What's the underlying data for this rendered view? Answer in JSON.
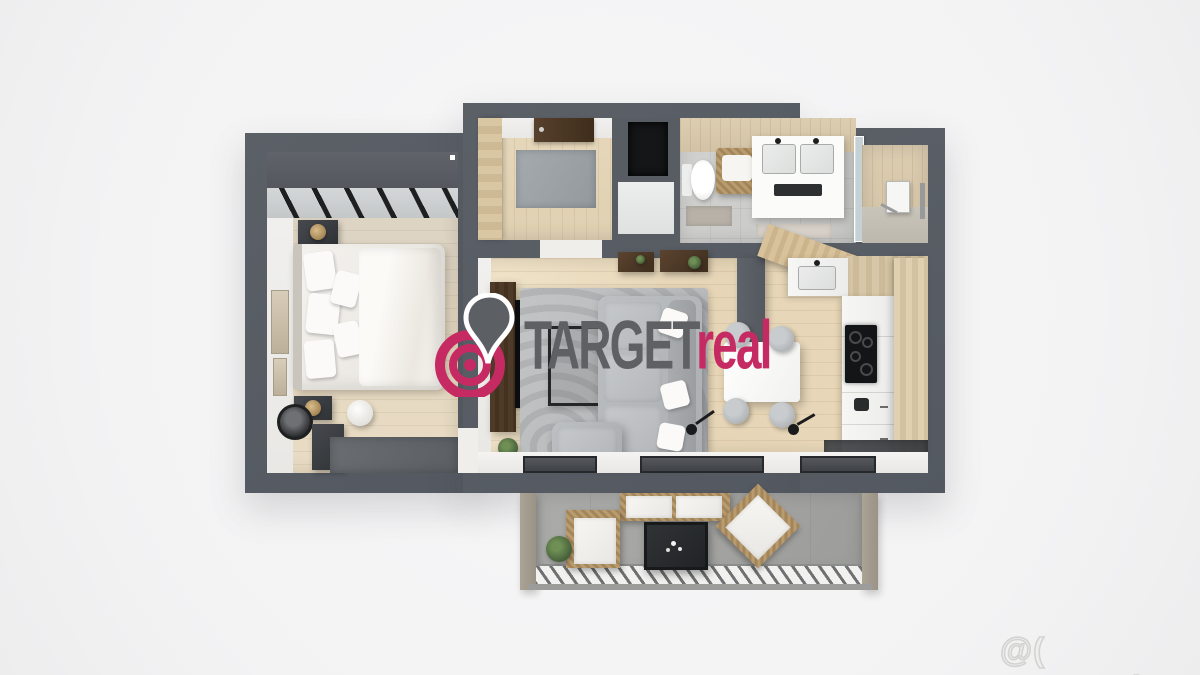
{
  "scene": {
    "description": "Top-down 3D render of a furnished apartment floor plan with balcony",
    "background_color": "#f5f5f6",
    "wall_color": "#575c63"
  },
  "agency_logo": {
    "icon": "map-pin-target-icon",
    "text_primary": "TARGET",
    "text_secondary": "real",
    "color_primary": "#5f6063",
    "color_accent": "#c62a63"
  },
  "site_watermark": {
    "text": "@( Bazos.sk",
    "color": "#d3d3d2"
  },
  "rooms": [
    {
      "name": "bedroom",
      "furnishings": [
        "double-bed",
        "nightstands-with-lamps",
        "built-in-wardrobe",
        "glass-partition",
        "dresser",
        "round-mirror",
        "pouf",
        "dark-rug",
        "wall-art"
      ]
    },
    {
      "name": "entry-hall",
      "furnishings": [
        "wardrobe",
        "entry-door",
        "gray-rug"
      ]
    },
    {
      "name": "utility-shaft",
      "furnishings": []
    },
    {
      "name": "bathroom",
      "furnishings": [
        "toilet",
        "laundry-basket",
        "double-vanity",
        "bath-mats",
        "glass-partition",
        "walk-in-shower",
        "towel-rail"
      ]
    },
    {
      "name": "living-room",
      "furnishings": [
        "corner-sofa",
        "patterned-rug",
        "tv-wall-unit",
        "wall-shelves",
        "coffee-table",
        "floor-lamp",
        "plant"
      ]
    },
    {
      "name": "kitchen-dining",
      "furnishings": [
        "l-shaped-white-cabinets",
        "cooktop",
        "sink",
        "wood-bar-counter",
        "tall-wood-cabinets",
        "dining-table",
        "four-chairs",
        "floor-lamp",
        "dark-mat"
      ]
    },
    {
      "name": "balcony",
      "furnishings": [
        "rattan-sofa",
        "rattan-armchair-left",
        "rattan-armchair-right",
        "dark-coffee-table",
        "plant",
        "slatted-railing"
      ]
    }
  ]
}
